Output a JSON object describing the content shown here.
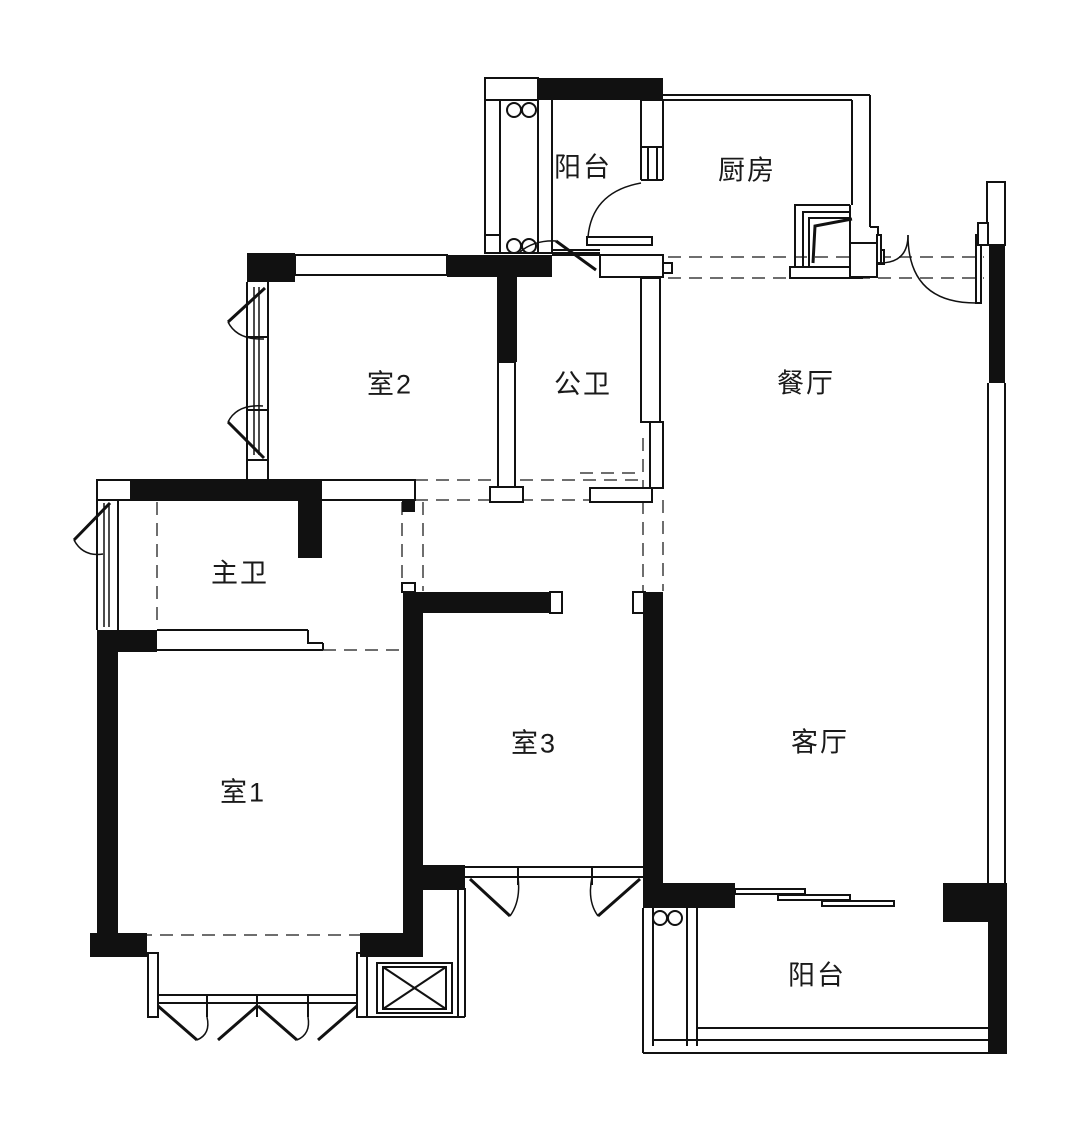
{
  "title": "apartment-floor-plan",
  "rooms": [
    {
      "id": "balcony-top",
      "label": "阳台"
    },
    {
      "id": "kitchen",
      "label": "厨房"
    },
    {
      "id": "bedroom-2",
      "label": "室2"
    },
    {
      "id": "public-bath",
      "label": "公卫"
    },
    {
      "id": "dining-room",
      "label": "餐厅"
    },
    {
      "id": "master-bath",
      "label": "主卫"
    },
    {
      "id": "bedroom-1",
      "label": "室1"
    },
    {
      "id": "bedroom-3",
      "label": "室3"
    },
    {
      "id": "living-room",
      "label": "客厅"
    },
    {
      "id": "balcony-bottom",
      "label": "阳台"
    }
  ],
  "colors": {
    "wall": "#111111",
    "line": "#1a1a1a",
    "dashed_guide": "#6e6e6e",
    "background": "#ffffff",
    "text": "#1a1a1a"
  }
}
